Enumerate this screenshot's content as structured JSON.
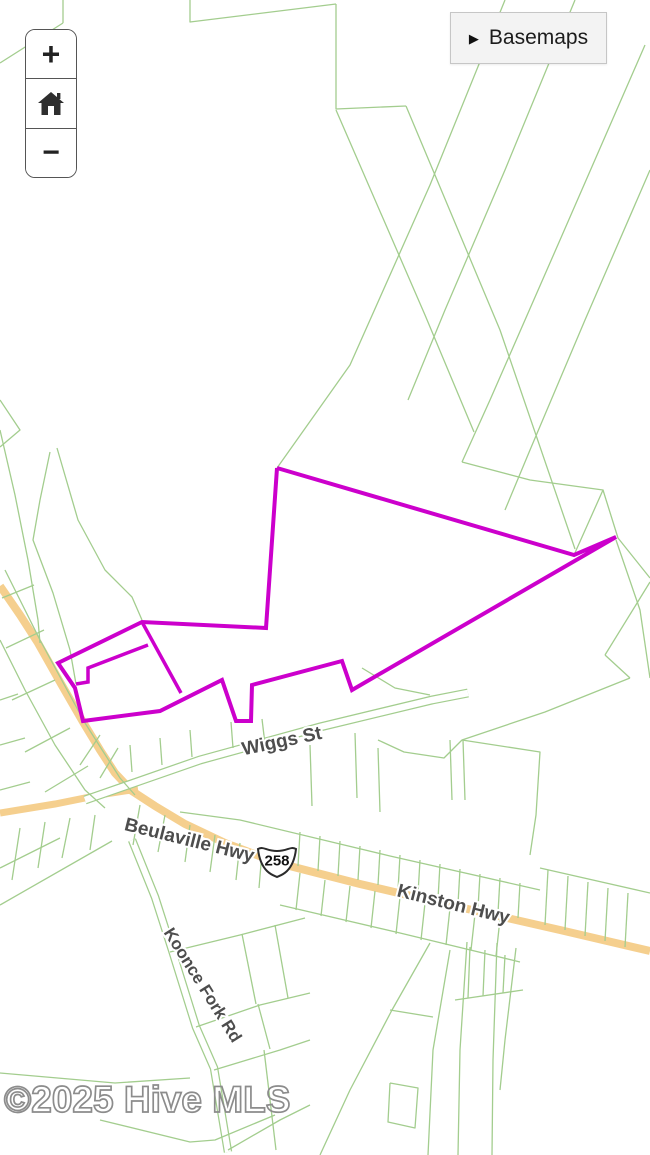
{
  "controls": {
    "zoom_in": "+",
    "zoom_out": "−",
    "basemaps_label": "Basemaps",
    "basemaps_arrow": "▶"
  },
  "watermark": {
    "text": "©2025 Hive MLS"
  },
  "map": {
    "colors": {
      "background": "#ffffff",
      "road": "#f5cf8e",
      "parcel_line": "#a3cd8e",
      "highlight": "#cc00cc",
      "label_text": "#4d4d4d",
      "label_halo": "#ffffff",
      "shield_outline": "#2b2b2b",
      "watermark": "#8c8c8c"
    },
    "shield": {
      "text": "258",
      "x": 277,
      "y": 860
    },
    "labels": [
      {
        "name": "street-label-wiggs-st",
        "text": "Wiggs St",
        "x": 283,
        "y": 747,
        "rotation": -12,
        "size": 19
      },
      {
        "name": "street-label-beulaville-hwy",
        "text": "Beulaville Hwy",
        "x": 188,
        "y": 846,
        "rotation": 14,
        "size": 19
      },
      {
        "name": "street-label-kinston-hwy",
        "text": "Kinston Hwy",
        "x": 452,
        "y": 910,
        "rotation": 14,
        "size": 19
      },
      {
        "name": "street-label-koonce-fork-rd",
        "text": "Koonce Fork Rd",
        "x": 198,
        "y": 988,
        "rotation": 58,
        "size": 17
      }
    ],
    "roads": [
      {
        "width": 8,
        "pts": [
          [
            0,
            586
          ],
          [
            20,
            615
          ],
          [
            38,
            643
          ],
          [
            60,
            682
          ],
          [
            83,
            722
          ],
          [
            100,
            750
          ],
          [
            115,
            773
          ],
          [
            132,
            791
          ],
          [
            155,
            806
          ],
          [
            185,
            824
          ],
          [
            225,
            843
          ],
          [
            278,
            863
          ],
          [
            360,
            884
          ],
          [
            450,
            905
          ],
          [
            560,
            930
          ],
          [
            650,
            951
          ]
        ]
      },
      {
        "width": 7,
        "pts": [
          [
            0,
            813
          ],
          [
            55,
            804
          ],
          [
            105,
            794
          ],
          [
            138,
            789
          ]
        ]
      }
    ],
    "cased_roads": [
      {
        "outer": 8.5,
        "inner": 6,
        "pts": [
          [
            132,
            840
          ],
          [
            155,
            897
          ],
          [
            172,
            950
          ],
          [
            196,
            1027
          ],
          [
            214,
            1068
          ],
          [
            228,
            1152
          ]
        ]
      },
      {
        "outer": 9,
        "inner": 6.5,
        "pts": [
          [
            85,
            800
          ],
          [
            200,
            760
          ],
          [
            320,
            727
          ],
          [
            432,
            700
          ],
          [
            468,
            693
          ]
        ]
      }
    ],
    "highlight": {
      "outline": [
        [
          277,
          468
        ],
        [
          266,
          628
        ],
        [
          142,
          622
        ],
        [
          58,
          663
        ],
        [
          75,
          688
        ],
        [
          83,
          721
        ],
        [
          160,
          711
        ],
        [
          222,
          680
        ],
        [
          236,
          721
        ],
        [
          251,
          721
        ],
        [
          252,
          685
        ],
        [
          342,
          661
        ],
        [
          352,
          690
        ],
        [
          616,
          537
        ],
        [
          574,
          555
        ],
        [
          277,
          468
        ]
      ],
      "inner": [
        [
          [
            142,
            622
          ],
          [
            181,
            693
          ]
        ],
        [
          [
            148,
            645
          ],
          [
            88,
            668
          ],
          [
            88,
            682
          ],
          [
            76,
            684
          ]
        ]
      ]
    },
    "parcel_lines": [
      [
        [
          0,
          63
        ],
        [
          63,
          23
        ]
      ],
      [
        [
          63,
          0
        ],
        [
          63,
          23
        ]
      ],
      [
        [
          190,
          0
        ],
        [
          190,
          22
        ],
        [
          336,
          4
        ]
      ],
      [
        [
          336,
          4
        ],
        [
          336,
          109
        ],
        [
          406,
          106
        ]
      ],
      [
        [
          336,
          110
        ],
        [
          425,
          315
        ],
        [
          474,
          432
        ]
      ],
      [
        [
          406,
          106
        ],
        [
          500,
          330
        ],
        [
          575,
          549
        ]
      ],
      [
        [
          505,
          0
        ],
        [
          430,
          185
        ],
        [
          350,
          365
        ],
        [
          277,
          468
        ]
      ],
      [
        [
          575,
          0
        ],
        [
          505,
          170
        ],
        [
          445,
          310
        ],
        [
          408,
          400
        ]
      ],
      [
        [
          645,
          45
        ],
        [
          560,
          240
        ],
        [
          490,
          400
        ],
        [
          462,
          462
        ]
      ],
      [
        [
          650,
          170
        ],
        [
          585,
          320
        ],
        [
          530,
          450
        ],
        [
          505,
          510
        ]
      ],
      [
        [
          462,
          462
        ],
        [
          530,
          480
        ],
        [
          603,
          490
        ],
        [
          574,
          555
        ]
      ],
      [
        [
          603,
          490
        ],
        [
          618,
          538
        ],
        [
          650,
          578
        ]
      ],
      [
        [
          616,
          540
        ],
        [
          640,
          610
        ],
        [
          650,
          678
        ]
      ],
      [
        [
          57,
          448
        ],
        [
          78,
          520
        ],
        [
          105,
          570
        ],
        [
          132,
          597
        ],
        [
          142,
          620
        ]
      ],
      [
        [
          50,
          452
        ],
        [
          40,
          500
        ],
        [
          33,
          540
        ],
        [
          53,
          593
        ],
        [
          70,
          650
        ],
        [
          76,
          684
        ]
      ],
      [
        [
          0,
          430
        ],
        [
          15,
          495
        ],
        [
          28,
          560
        ],
        [
          38,
          620
        ],
        [
          40,
          643
        ]
      ],
      [
        [
          5,
          570
        ],
        [
          40,
          640
        ],
        [
          85,
          723
        ],
        [
          120,
          778
        ],
        [
          135,
          795
        ]
      ],
      [
        [
          0,
          640
        ],
        [
          25,
          690
        ],
        [
          55,
          745
        ],
        [
          85,
          790
        ],
        [
          105,
          808
        ]
      ],
      [
        [
          2,
          598
        ],
        [
          34,
          585
        ]
      ],
      [
        [
          6,
          648
        ],
        [
          44,
          630
        ]
      ],
      [
        [
          12,
          700
        ],
        [
          55,
          680
        ]
      ],
      [
        [
          25,
          752
        ],
        [
          70,
          728
        ]
      ],
      [
        [
          45,
          792
        ],
        [
          88,
          766
        ]
      ],
      [
        [
          0,
          700
        ],
        [
          18,
          694
        ]
      ],
      [
        [
          0,
          745
        ],
        [
          25,
          738
        ]
      ],
      [
        [
          0,
          790
        ],
        [
          30,
          782
        ]
      ],
      [
        [
          0,
          905
        ],
        [
          112,
          841
        ]
      ],
      [
        [
          20,
          828
        ],
        [
          12,
          880
        ]
      ],
      [
        [
          45,
          822
        ],
        [
          38,
          868
        ]
      ],
      [
        [
          70,
          818
        ],
        [
          62,
          858
        ]
      ],
      [
        [
          95,
          815
        ],
        [
          90,
          850
        ]
      ],
      [
        [
          0,
          868
        ],
        [
          60,
          838
        ]
      ],
      [
        [
          100,
          1120
        ],
        [
          190,
          1142
        ],
        [
          215,
          1140
        ],
        [
          275,
          1115
        ]
      ],
      [
        [
          0,
          1073
        ],
        [
          115,
          1083
        ],
        [
          190,
          1078
        ]
      ],
      [
        [
          231,
          722
        ],
        [
          233,
          748
        ]
      ],
      [
        [
          262,
          719
        ],
        [
          265,
          744
        ]
      ],
      [
        [
          190,
          730
        ],
        [
          192,
          757
        ]
      ],
      [
        [
          160,
          738
        ],
        [
          162,
          765
        ]
      ],
      [
        [
          130,
          745
        ],
        [
          132,
          772
        ]
      ],
      [
        [
          100,
          735
        ],
        [
          80,
          765
        ]
      ],
      [
        [
          118,
          748
        ],
        [
          100,
          778
        ]
      ],
      [
        [
          362,
          668
        ],
        [
          395,
          688
        ],
        [
          430,
          695
        ]
      ],
      [
        [
          310,
          745
        ],
        [
          312,
          806
        ]
      ],
      [
        [
          355,
          733
        ],
        [
          357,
          798
        ]
      ],
      [
        [
          378,
          748
        ],
        [
          380,
          812
        ]
      ],
      [
        [
          450,
          740
        ],
        [
          452,
          800
        ]
      ],
      [
        [
          463,
          740
        ],
        [
          465,
          800
        ]
      ],
      [
        [
          180,
          812
        ],
        [
          240,
          820
        ],
        [
          390,
          856
        ],
        [
          540,
          890
        ]
      ],
      [
        [
          300,
          832
        ],
        [
          298,
          866
        ]
      ],
      [
        [
          320,
          836
        ],
        [
          318,
          871
        ]
      ],
      [
        [
          340,
          841
        ],
        [
          338,
          876
        ]
      ],
      [
        [
          360,
          846
        ],
        [
          358,
          880
        ]
      ],
      [
        [
          380,
          850
        ],
        [
          378,
          885
        ]
      ],
      [
        [
          400,
          855
        ],
        [
          398,
          890
        ]
      ],
      [
        [
          420,
          860
        ],
        [
          418,
          894
        ]
      ],
      [
        [
          440,
          864
        ],
        [
          438,
          899
        ]
      ],
      [
        [
          460,
          869
        ],
        [
          458,
          904
        ]
      ],
      [
        [
          480,
          874
        ],
        [
          478,
          908
        ]
      ],
      [
        [
          500,
          878
        ],
        [
          498,
          913
        ]
      ],
      [
        [
          520,
          883
        ],
        [
          518,
          918
        ]
      ],
      [
        [
          540,
          868
        ],
        [
          650,
          893
        ]
      ],
      [
        [
          548,
          870
        ],
        [
          545,
          925
        ]
      ],
      [
        [
          568,
          876
        ],
        [
          565,
          930
        ]
      ],
      [
        [
          588,
          882
        ],
        [
          585,
          936
        ]
      ],
      [
        [
          608,
          888
        ],
        [
          605,
          941
        ]
      ],
      [
        [
          628,
          893
        ],
        [
          625,
          947
        ]
      ],
      [
        [
          462,
          740
        ],
        [
          540,
          752
        ],
        [
          536,
          815
        ],
        [
          530,
          855
        ]
      ],
      [
        [
          280,
          905
        ],
        [
          400,
          933
        ],
        [
          520,
          962
        ]
      ],
      [
        [
          300,
          873
        ],
        [
          296,
          910
        ]
      ],
      [
        [
          325,
          880
        ],
        [
          321,
          916
        ]
      ],
      [
        [
          350,
          886
        ],
        [
          346,
          922
        ]
      ],
      [
        [
          375,
          891
        ],
        [
          371,
          928
        ]
      ],
      [
        [
          400,
          897
        ],
        [
          396,
          934
        ]
      ],
      [
        [
          425,
          903
        ],
        [
          421,
          940
        ]
      ],
      [
        [
          450,
          908
        ],
        [
          446,
          945
        ]
      ],
      [
        [
          475,
          914
        ],
        [
          471,
          950
        ]
      ],
      [
        [
          500,
          919
        ],
        [
          496,
          956
        ]
      ],
      [
        [
          140,
          805
        ],
        [
          133,
          845
        ]
      ],
      [
        [
          165,
          815
        ],
        [
          158,
          852
        ]
      ],
      [
        [
          190,
          825
        ],
        [
          185,
          862
        ]
      ],
      [
        [
          215,
          835
        ],
        [
          210,
          872
        ]
      ],
      [
        [
          240,
          843
        ],
        [
          236,
          880
        ]
      ],
      [
        [
          262,
          852
        ],
        [
          259,
          888
        ]
      ],
      [
        [
          430,
          943
        ],
        [
          392,
          1010
        ],
        [
          350,
          1090
        ],
        [
          320,
          1155
        ]
      ],
      [
        [
          450,
          950
        ],
        [
          433,
          1050
        ],
        [
          428,
          1155
        ]
      ],
      [
        [
          467,
          942
        ],
        [
          460,
          1050
        ],
        [
          458,
          1155
        ]
      ],
      [
        [
          497,
          943
        ],
        [
          493,
          1060
        ],
        [
          492,
          1155
        ]
      ],
      [
        [
          516,
          948
        ],
        [
          505,
          1040
        ],
        [
          500,
          1090
        ]
      ],
      [
        [
          390,
          1010
        ],
        [
          433,
          1017
        ]
      ],
      [
        [
          390,
          1083
        ],
        [
          418,
          1088
        ],
        [
          415,
          1128
        ],
        [
          388,
          1122
        ],
        [
          390,
          1083
        ]
      ],
      [
        [
          455,
          1000
        ],
        [
          523,
          990
        ]
      ],
      [
        [
          470,
          947
        ],
        [
          468,
          998
        ]
      ],
      [
        [
          485,
          950
        ],
        [
          483,
          996
        ]
      ],
      [
        [
          505,
          955
        ],
        [
          503,
          993
        ]
      ],
      [
        [
          170,
          952
        ],
        [
          240,
          935
        ],
        [
          305,
          918
        ]
      ],
      [
        [
          196,
          1027
        ],
        [
          260,
          1005
        ],
        [
          310,
          993
        ]
      ],
      [
        [
          214,
          1070
        ],
        [
          280,
          1050
        ],
        [
          310,
          1040
        ]
      ],
      [
        [
          242,
          934
        ],
        [
          256,
          1004
        ]
      ],
      [
        [
          275,
          925
        ],
        [
          288,
          998
        ]
      ],
      [
        [
          258,
          1004
        ],
        [
          270,
          1049
        ]
      ],
      [
        [
          228,
          1150
        ],
        [
          280,
          1120
        ],
        [
          310,
          1105
        ]
      ],
      [
        [
          264,
          1050
        ],
        [
          276,
          1150
        ]
      ],
      [
        [
          650,
          582
        ],
        [
          605,
          655
        ]
      ],
      [
        [
          605,
          655
        ],
        [
          630,
          678
        ]
      ],
      [
        [
          630,
          678
        ],
        [
          545,
          712
        ],
        [
          462,
          740
        ],
        [
          444,
          758
        ],
        [
          404,
          752
        ],
        [
          378,
          740
        ]
      ],
      [
        [
          0,
          400
        ],
        [
          20,
          430
        ],
        [
          0,
          447
        ]
      ]
    ]
  }
}
